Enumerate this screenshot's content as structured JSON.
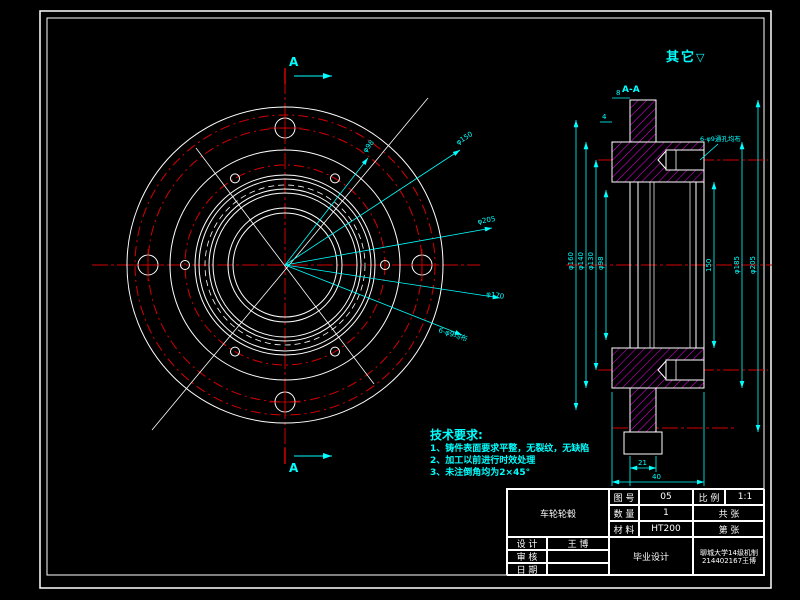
{
  "other_mark": {
    "label": "其它",
    "symbol": "▽"
  },
  "tech_req": {
    "title": "技术要求:",
    "items": [
      "1、铸件表面要求平整，无裂纹，无缺陷",
      "2、加工以前进行时效处理",
      "3、未注倒角均为2×45°"
    ]
  },
  "front_view": {
    "section_label_top": "A",
    "section_label_bottom": "A",
    "leaders": [
      {
        "label": "φ98"
      },
      {
        "label": "φ150"
      },
      {
        "label": "φ205"
      },
      {
        "label": "φ170"
      },
      {
        "label": "6-φ9均布"
      }
    ]
  },
  "side_view": {
    "title": "A-A",
    "note": "6-φ9通孔均布",
    "dims": {
      "left": [
        "φ160",
        "φ140",
        "φ130",
        "φ98"
      ],
      "right": [
        "150",
        "φ185",
        "φ205"
      ],
      "bottom": [
        "21",
        "40"
      ],
      "top": [
        "8",
        "4"
      ]
    }
  },
  "title_block": {
    "part_name": "车轮轮毂",
    "labels": {
      "drawing_no": "图 号",
      "scale": "比 例",
      "quantity": "数 量",
      "material": "材 料",
      "design": "设 计",
      "check": "审 核",
      "date": "日 期"
    },
    "values": {
      "drawing_no": "05",
      "scale": "1:1",
      "quantity": "1",
      "material": "HT200",
      "designer": "王 博",
      "checker": "",
      "date": "",
      "sheet_total": "共  张",
      "sheet_no": "第  张"
    },
    "project": "毕业设计",
    "org_line1": "聊城大学14级机制",
    "org_line2": "214402167王博"
  }
}
